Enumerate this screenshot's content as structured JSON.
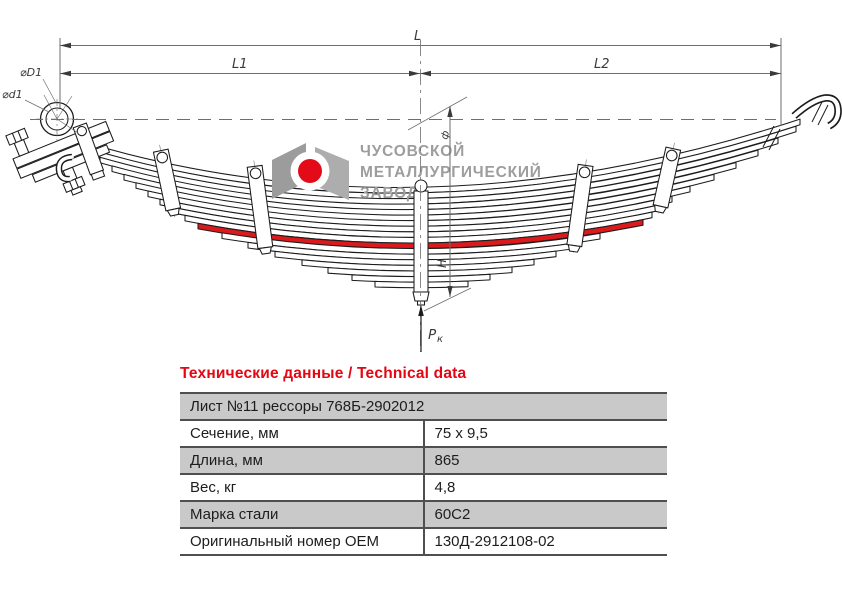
{
  "drawing": {
    "dim_labels": {
      "length_total": "L",
      "length_left": "L1",
      "length_right": "L2",
      "eye_outer": "⌀D1",
      "eye_inner": "⌀d1",
      "height": "H",
      "thickness_mark": "ф",
      "load_main": "Р",
      "load_sub": "к"
    },
    "watermark": {
      "line1": "ЧУСОВСКОЙ",
      "line2": "МЕТАЛЛУРГИЧЕСКИЙ",
      "line3": "ЗАВОД"
    },
    "colors": {
      "highlight_leaf": "#dc1a1c",
      "watermark_gray": "#9d9d9d",
      "logo_red": "#e30b17",
      "logo_gray_left": "#9c9c9c",
      "logo_gray_right": "#adadad"
    }
  },
  "table": {
    "title": "Технические данные / Technical data",
    "title_color": "#e30613",
    "row_gray": "#c9c9c9",
    "header": "Лист №11 рессоры 768Б-2902012",
    "rows": [
      {
        "label": "Сечение, мм",
        "value": "75 x 9,5"
      },
      {
        "label": "Длина, мм",
        "value": "865"
      },
      {
        "label": "Вес, кг",
        "value": "4,8"
      },
      {
        "label": "Марка стали",
        "value": "60С2"
      },
      {
        "label": "Оригинальный номер OEM",
        "value": "130Д-2912108-02"
      }
    ]
  }
}
